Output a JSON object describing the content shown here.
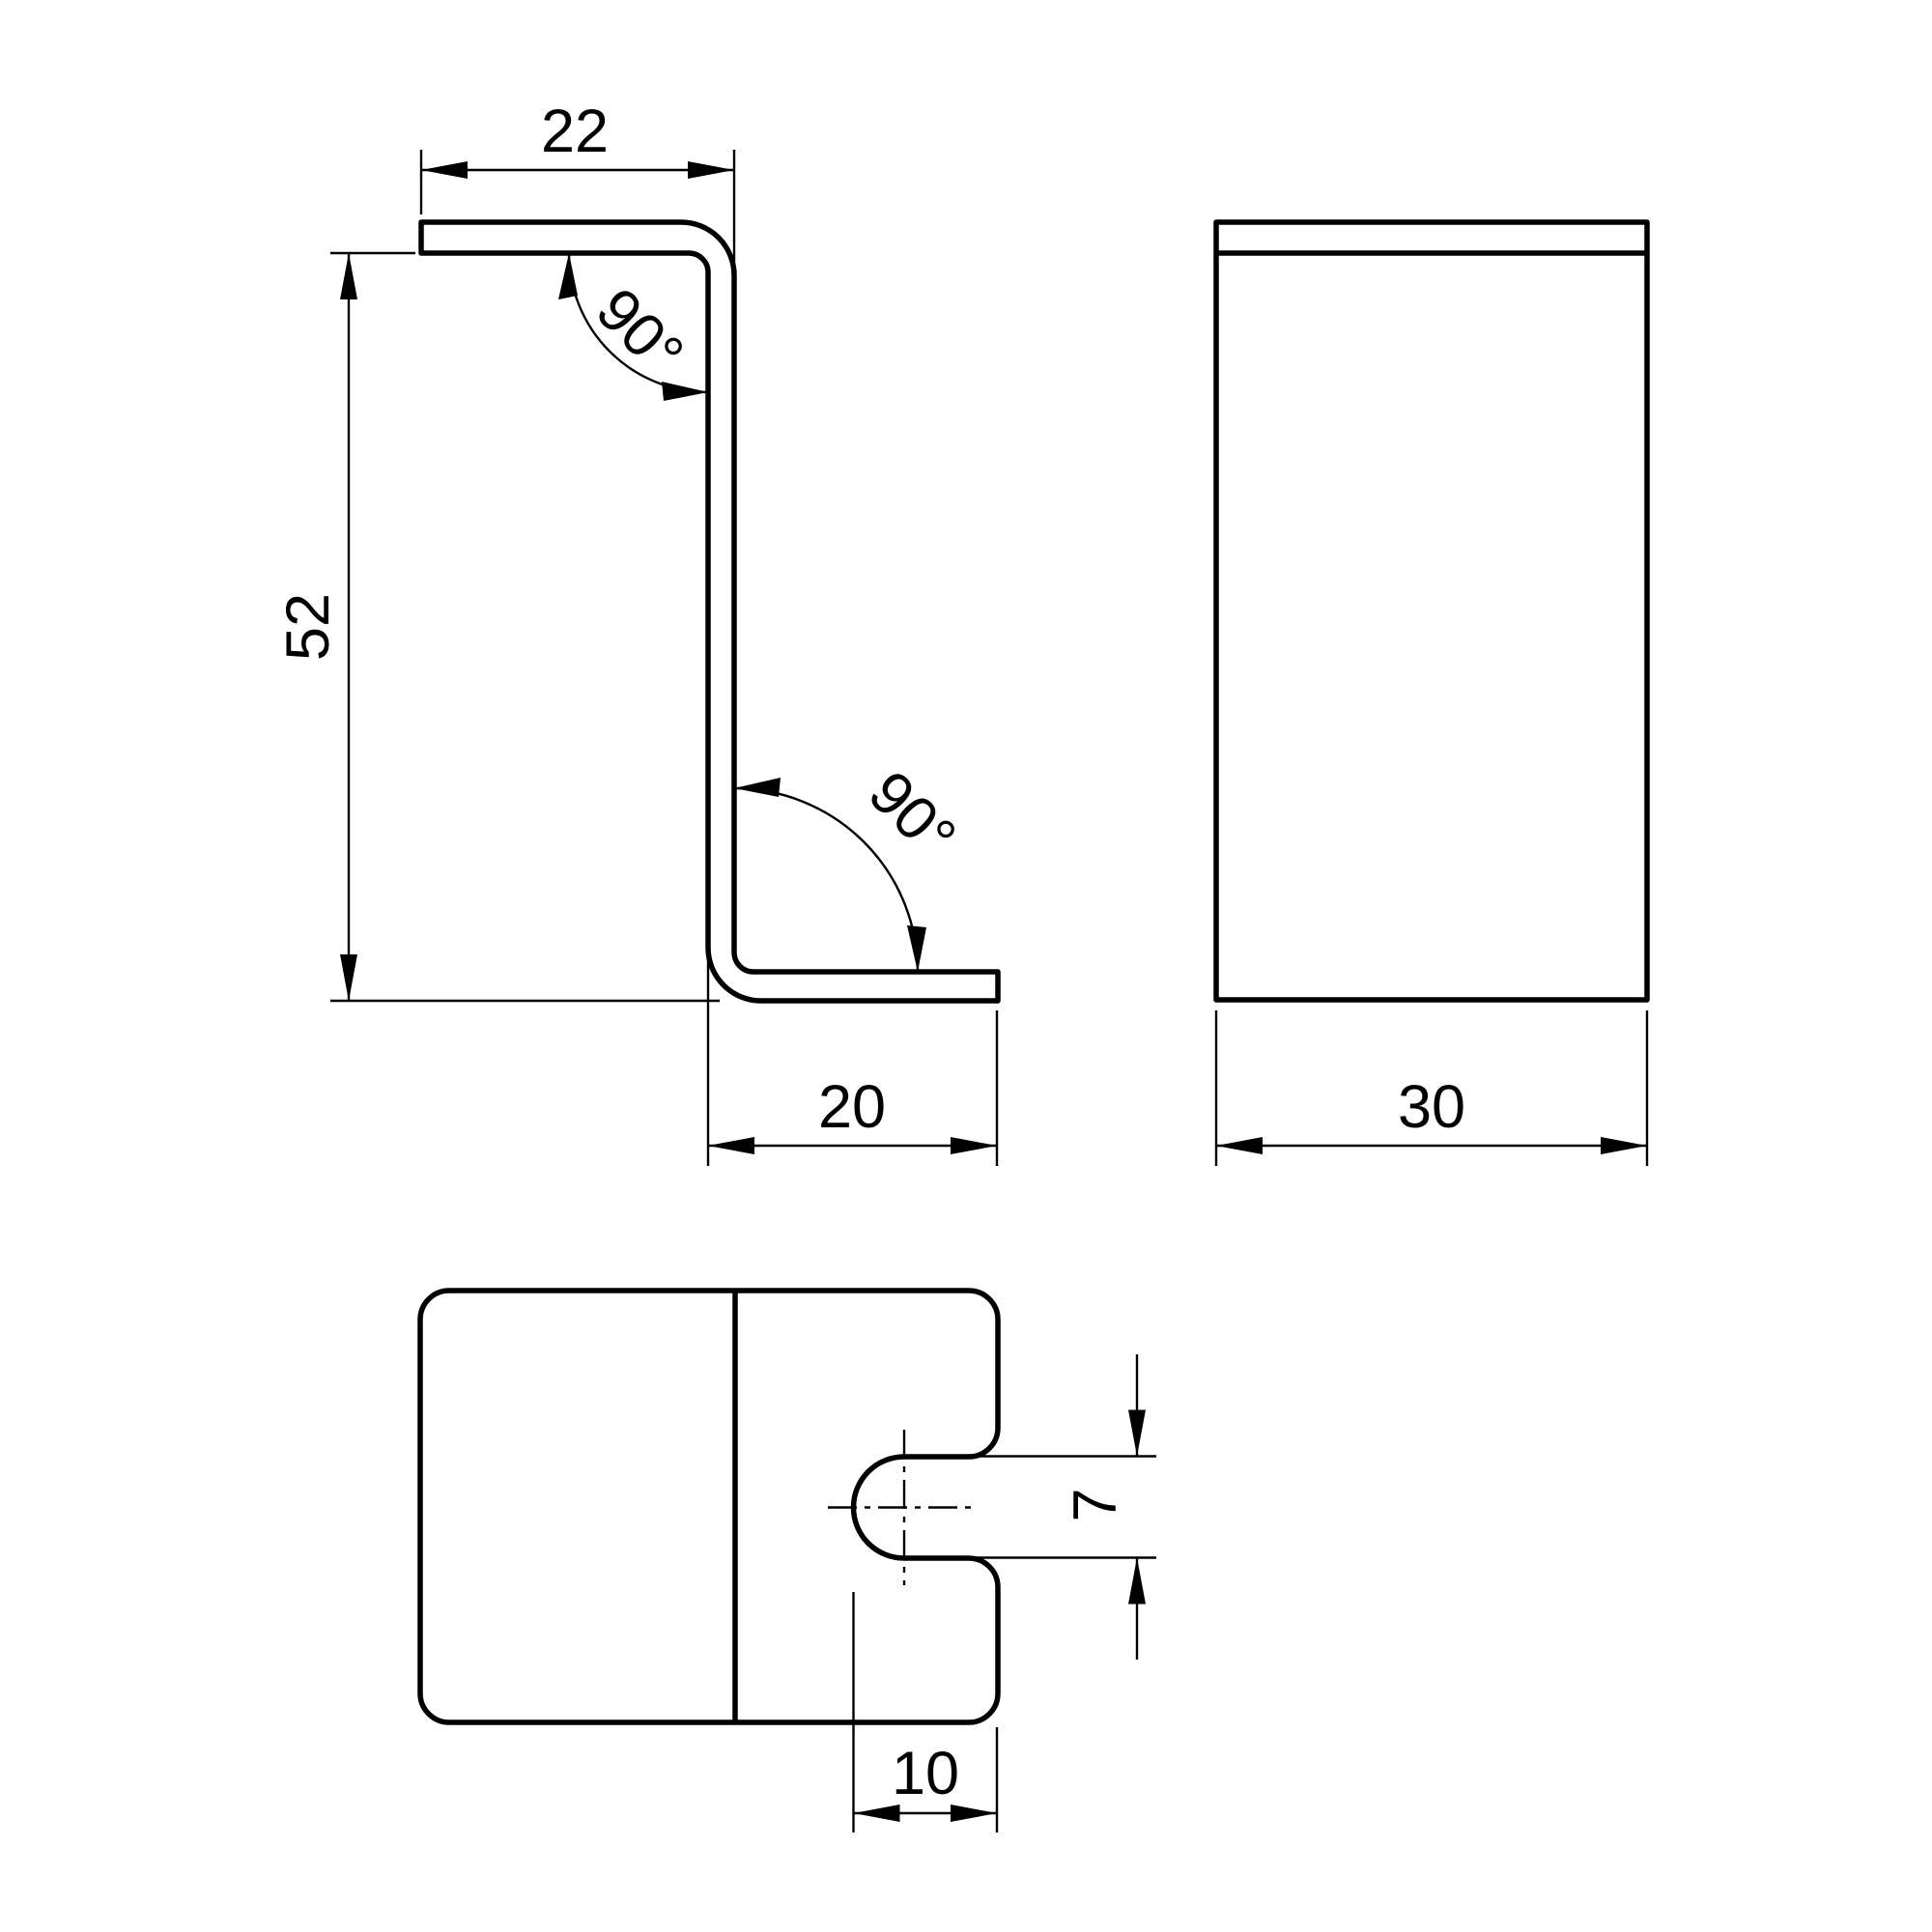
{
  "drawing": {
    "title": "Z-bracket three-view technical drawing",
    "background_color": "#ffffff",
    "line_color": "#000000",
    "views": {
      "side_view": "side profile of Z-bent sheet bracket with two 90 degree bends",
      "front_view": "front face rectangle with top flange edge line",
      "top_view": "top outline with rounded corners, bend edge line and open slot with centerlines"
    }
  },
  "dimensions": {
    "top_flange_length": "22",
    "overall_height": "52",
    "bottom_flange_length": "20",
    "upper_bend_angle": "90°",
    "lower_bend_angle": "90°",
    "depth": "30",
    "slot_depth": "10",
    "slot_width": "7"
  }
}
